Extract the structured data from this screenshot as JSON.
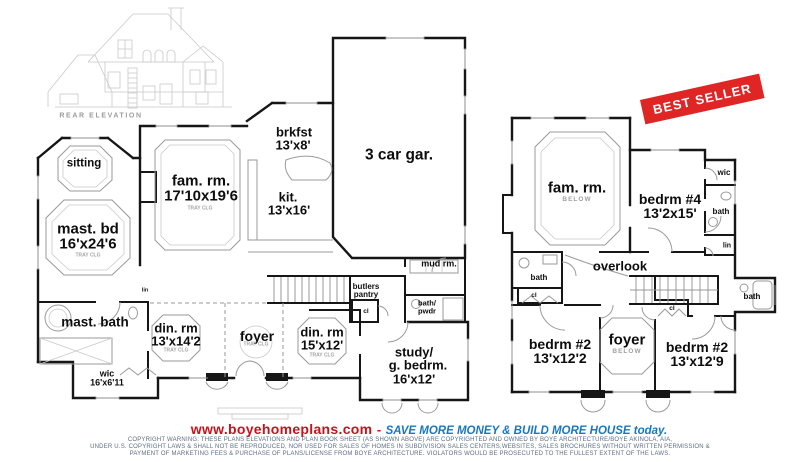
{
  "colors": {
    "wall": "#161616",
    "detail": "#9a9a9a",
    "stamp": "#e02525",
    "url": "#c6121d",
    "tag": "#1878be",
    "copy": "#5c6e84"
  },
  "elevation": {
    "caption": "REAR ELEVATION"
  },
  "stamp": {
    "label": "BEST SELLER"
  },
  "f1": {
    "sitting": "sitting",
    "mast_bd": "mast. bd",
    "mast_bd_dim": "16'x24'6",
    "fam_rm": "fam. rm.",
    "fam_rm_dim": "17'10x19'6",
    "tray": "TRAY CLG",
    "brkfst": "brkfst",
    "brkfst_dim": "13'x8'",
    "kit": "kit.",
    "kit_dim": "13'x16'",
    "garage": "3 car gar.",
    "mud": "mud rm.",
    "mast_bath": "mast. bath",
    "din1": "din. rm",
    "din1_dim": "13'x14'2",
    "foyer": "foyer",
    "din2": "din. rm",
    "din2_dim": "15'x12'",
    "study1": "study/",
    "study2": "g. bedrm.",
    "study_dim": "16'x12'",
    "wic": "wic",
    "wic_dim": "16'x6'11",
    "butlers1": "butlers",
    "butlers2": "pantry",
    "bp1": "bath/",
    "bp2": "pwdr",
    "cl": "cl",
    "lin": "lin"
  },
  "f2": {
    "fam": "fam. rm.",
    "below": "BELOW",
    "bed4": "bedrm #4",
    "bed4_dim": "13'2x15'",
    "wic": "wic",
    "bath": "bath",
    "lin": "lin",
    "overlook": "overlook",
    "bath_left": "bath",
    "cl_left": "cl",
    "bed2l": "bedrm #2",
    "bed2l_dim": "13'x12'2",
    "foyer": "foyer",
    "bed2r": "bedrm #2",
    "bed2r_dim": "13'x12'9",
    "cl_right": "cl",
    "bath_right": "bath"
  },
  "footer": {
    "url": "www.boyehomeplans.com",
    "dash": "-",
    "tagline": "SAVE MORE MONEY & BUILD MORE HOUSE today.",
    "c1": "COPYRIGHT WARNING: THESE PLANS ELEVATIONS AND PLAN BOOK SHEET (AS SHOWN ABOVE) ARE COPYRIGHTED AND OWNED BY BOYE ARCHITECTURE/BOYE AKINOLA, AIA,",
    "c2": "UNDER U.S. COPYRIGHT LAWS & SHALL NOT BE REPRODUCED, NOR USED FOR SALES OF HOMES IN SUBDIVISION SALES CENTERS,WEBSITES, SALES BROCHURES WITHOUT WRITTEN PERMISSION &",
    "c3": "PAYMENT OF MARKETING FEES & PURCHASE OF  PLANS/LICENSE FROM BOYE ARCHITECTURE. VIOLATORS  WOULD BE PROSECUTED TO THE FULLEST EXTENT OF THE LAWS."
  }
}
